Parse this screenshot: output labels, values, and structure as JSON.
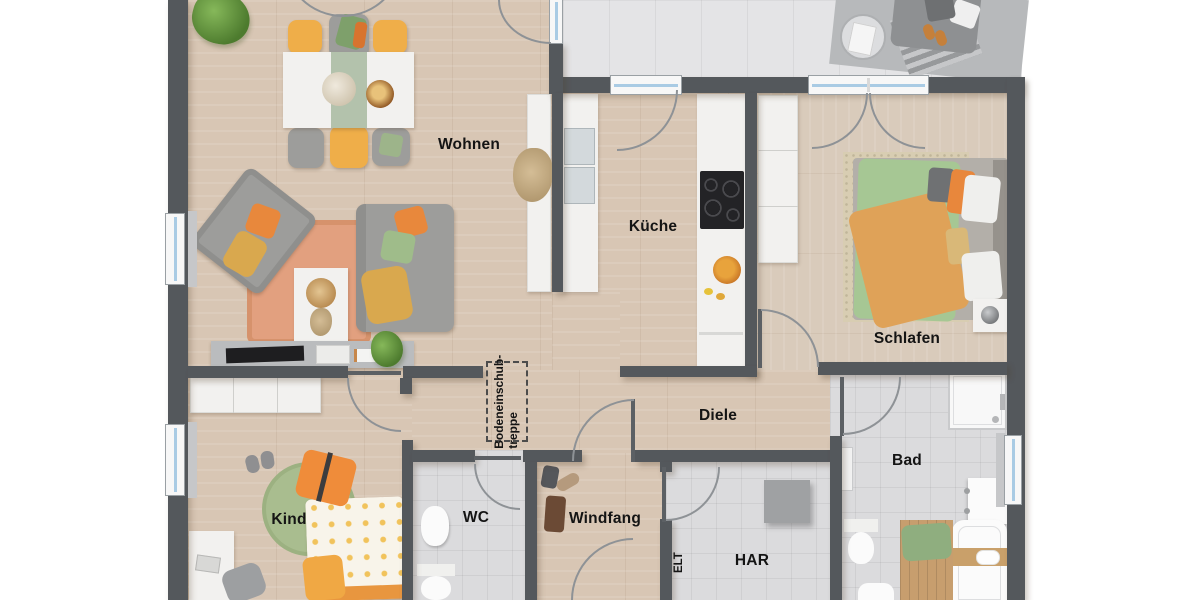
{
  "plan": {
    "rooms": {
      "wohnen": {
        "label": "Wohnen"
      },
      "kueche": {
        "label": "Küche"
      },
      "schlafen": {
        "label": "Schlafen"
      },
      "diele": {
        "label": "Diele"
      },
      "bad": {
        "label": "Bad"
      },
      "kind": {
        "label": "Kind"
      },
      "wc": {
        "label": "WC"
      },
      "windfang": {
        "label": "Windfang"
      },
      "har": {
        "label": "HAR"
      },
      "elt": {
        "label": "ELT"
      }
    },
    "annotations": {
      "attic_stairs_line1": "Bodeneinschub-",
      "attic_stairs_line2": "treppe"
    },
    "colors": {
      "wall": "#54585c",
      "wood_floor": "#d8c6b4",
      "tile_floor": "#dbdbdd",
      "terrace_floor": "#e4e4e6",
      "window_glass": "#a9cbe4",
      "accent_orange": "#e8883c",
      "accent_green": "#a5c28f",
      "accent_yellow": "#efae49"
    }
  }
}
